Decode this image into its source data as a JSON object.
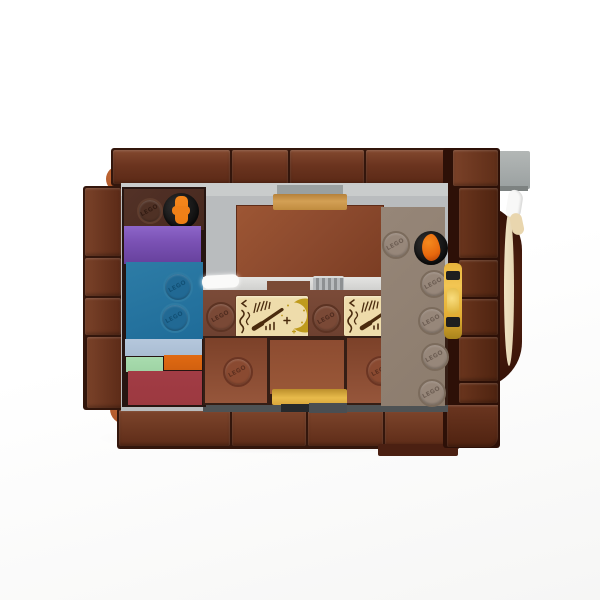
{
  "stud": {
    "label": "LEGO"
  },
  "printed_tiles": {
    "count": 2,
    "motifs": [
      "rune-scribbles",
      "tally-sparks",
      "magic-wand",
      "sparkle-plus",
      "crescent-moon",
      "star-dots"
    ]
  },
  "colors": {
    "background": "#fdfdfd",
    "frame_brown": "#6b341f",
    "seam_dark": "#33160c",
    "corner_orange": "#ad5628",
    "interior_gray": "#b9bcbe",
    "dark_brown_plate": "#46281e",
    "purple_brick": "#7b52b5",
    "blue_brick": "#1f6c99",
    "sand_blue_plate": "#a9bdd3",
    "green_plate": "#9ed3a4",
    "orange_plate": "#d2600f",
    "dark_red_brick": "#9c3940",
    "rust_tile": "#8c4a2e",
    "bottom_tile_brown": "#86462e",
    "taupe_plate": "#8c7c6d",
    "print_tile_tan": "#eedcab",
    "print_brown": "#4a2b0e",
    "print_gold": "#bf9b1d",
    "gold_latch": "#e2ad33",
    "handle_tan": "#d3a055",
    "handle_gold": "#e7ba4b",
    "flame_orange": "#e8680d",
    "lever_orange": "#ed7d14",
    "black_piece": "#161616",
    "white_piece": "#f8f8f7",
    "gray_piece": "#9aa0a0",
    "cream_piece": "#e6d5b2",
    "disc_dark_brown": "#451a0c"
  }
}
